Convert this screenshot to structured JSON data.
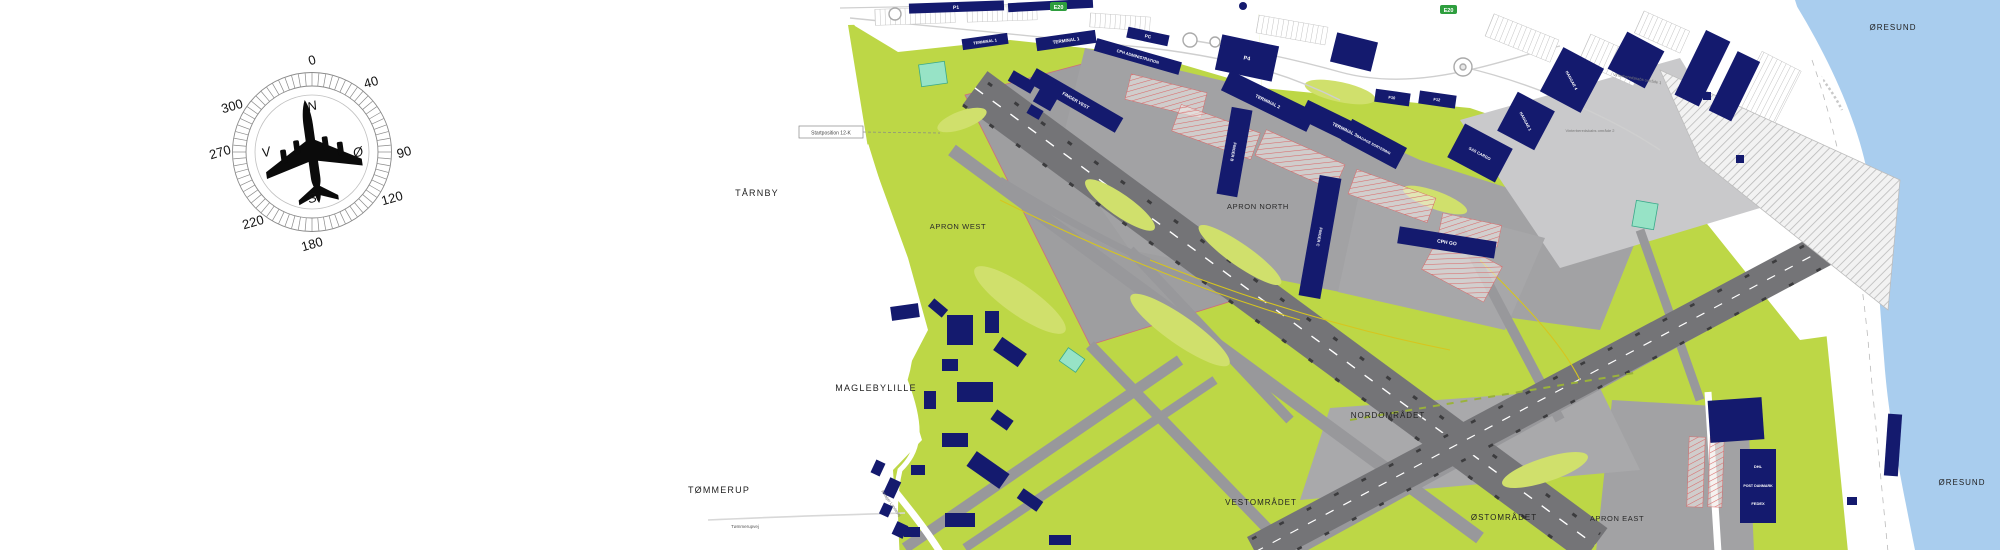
{
  "compass": {
    "degrees": [
      "0",
      "40",
      "90",
      "120",
      "180",
      "220",
      "270",
      "300"
    ],
    "cardinals": {
      "n": "N",
      "e": "Ø",
      "s": "S",
      "v": "V"
    }
  },
  "labels": {
    "tarnby": "TÅRNBY",
    "maglebylille": "MAGLEBYLILLE",
    "tommerup": "TØMMERUP",
    "tommerupvej": "Tømmerupvej",
    "oresund_top": "ØRESUND",
    "oresund_bottom": "ØRESUND",
    "apron_west": "APRON WEST",
    "apron_north": "APRON NORTH",
    "apron_east": "APRON EAST",
    "nordomradet": "NORDOMRÅDET",
    "vestomradet": "VESTOMRÅDET",
    "ostomradet": "ØSTOMRÅDET",
    "p1": "P1",
    "terminal1a": "TERMINAL 1",
    "terminal1b": "TERMINAL 1",
    "pc": "PC",
    "cph_admin": "CPH ADMINISTRATION",
    "finger_vest": "FINGER VEST",
    "p4": "P4",
    "terminal2": "TERMINAL 2",
    "terminal3": "TERMINAL 3",
    "finger_b": "FINGER B",
    "finger_c": "FINGER C",
    "cph_go": "CPH GO",
    "f10": "F10",
    "f12": "F12",
    "bagage": "BAGAGE SORTERING",
    "sas_cargo": "SAS CARGO",
    "hangar1": "HANGAR 1",
    "hangar4": "HANGAR 4",
    "dhl": "DHL",
    "post_danmark": "POST DANMARK",
    "fedex": "FEDEX",
    "e20_west": "E20",
    "e20_east": "E20",
    "startposition": "Startposition 12-K",
    "vinter1": "Vinterberedskabs område 1",
    "vinter2": "Vinterberedskabs område 2",
    "amager_landevej": "Amager Landevej"
  },
  "colors": {
    "water": "#a9cdee",
    "grass": "#bdd746",
    "grass_light": "#d0e06c",
    "runway": "#747477",
    "taxiway": "#98989b",
    "apron": "#a2a2a4",
    "building": "#141a6e",
    "stand_red": "#d96a6a",
    "shield_green": "#2e9e3e"
  }
}
